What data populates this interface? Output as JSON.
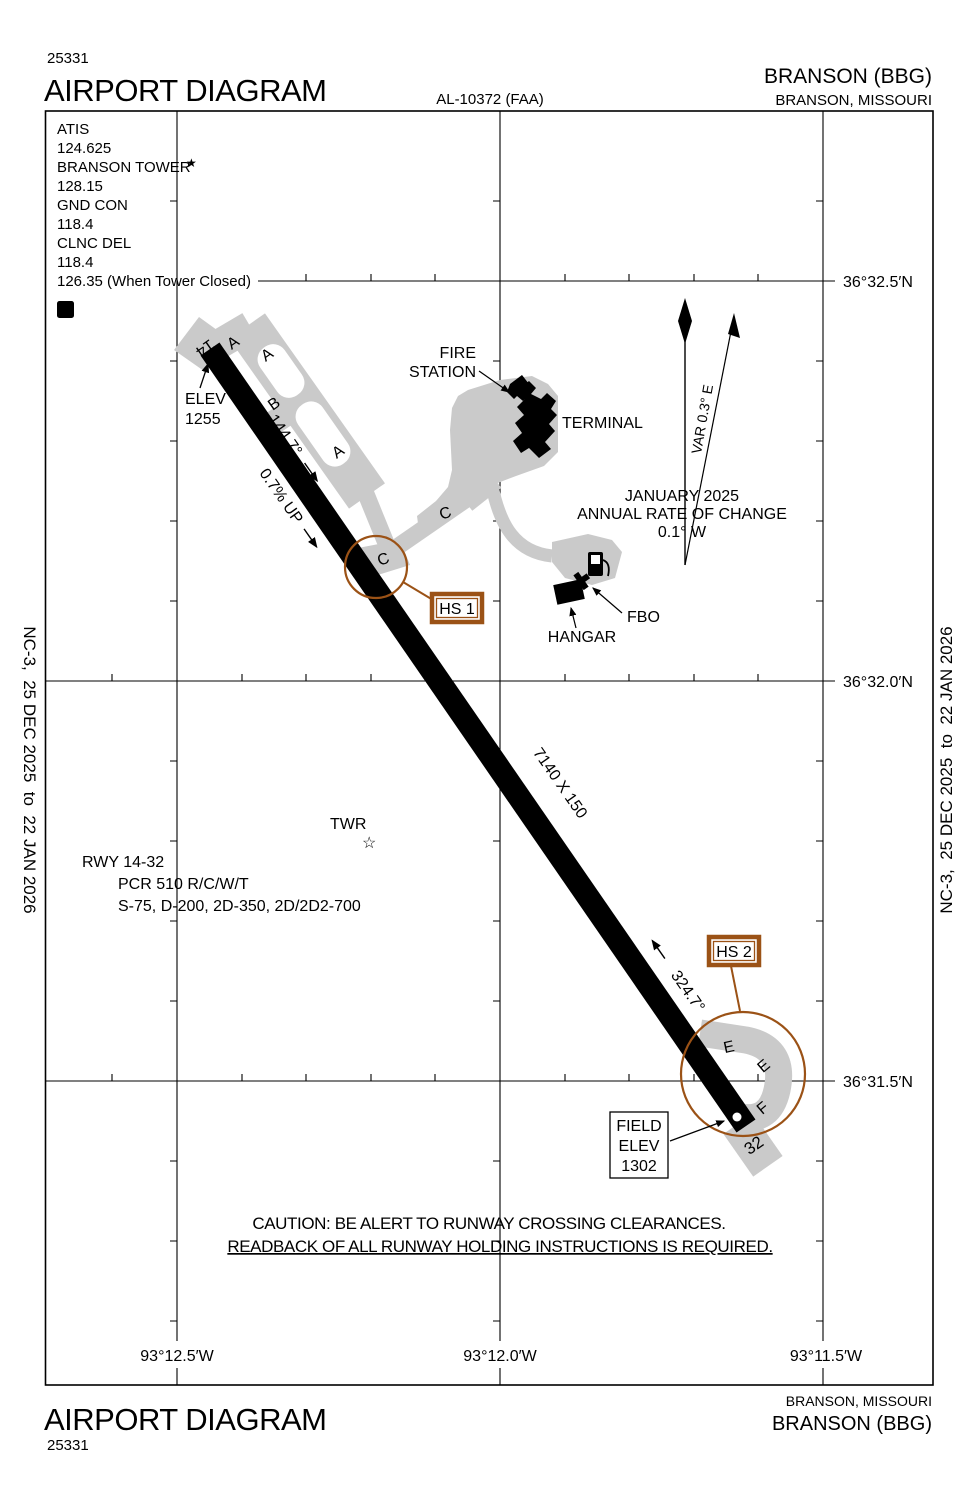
{
  "header": {
    "plate_code": "25331",
    "title": "AIRPORT DIAGRAM",
    "al_number": "AL-10372 (FAA)",
    "airport": "BRANSON (BBG)",
    "city": "BRANSON, MISSOURI"
  },
  "footer": {
    "plate_code": "25331",
    "title": "AIRPORT DIAGRAM",
    "airport": "BRANSON (BBG)",
    "city": "BRANSON, MISSOURI"
  },
  "margin_note": "NC-3,  25 DEC 2025  to  22 JAN 2026",
  "comm": {
    "lines": [
      "ATIS",
      "124.625",
      "BRANSON TOWER",
      "128.15",
      "GND CON",
      "118.4",
      "CLNC DEL",
      "118.4",
      "126.35 (When Tower Closed)"
    ],
    "tower_star": "★",
    "declared_distances_symbol": "D"
  },
  "compass": {
    "variation": "VAR 0.3° E",
    "epoch": "JANUARY 2025",
    "rate_label": "ANNUAL RATE OF CHANGE",
    "rate_value": "0.1° W"
  },
  "runway": {
    "id14": "14",
    "id32": "32",
    "heading14": "144.7°",
    "heading32": "324.7°",
    "slope": "0.7% UP",
    "dimensions": "7140 X 150",
    "threshold_elev_label": "ELEV",
    "threshold_elev_value": "1255"
  },
  "field_elev": {
    "l1": "FIELD",
    "l2": "ELEV",
    "l3": "1302"
  },
  "buildings": {
    "fire_station_l1": "FIRE",
    "fire_station_l2": "STATION",
    "terminal": "TERMINAL",
    "hangar": "HANGAR",
    "fbo": "FBO",
    "tower": "TWR",
    "tower_star": "☆"
  },
  "taxiways": {
    "a1": "A",
    "a2": "A",
    "b": "B",
    "a3": "A",
    "c1": "C",
    "c2": "C",
    "e1": "E",
    "e2": "E",
    "f": "F"
  },
  "hotspots": {
    "hs1": "HS 1",
    "hs2": "HS 2"
  },
  "runway_data": {
    "l1": "RWY 14-32",
    "l2": "PCR 510 R/C/W/T",
    "l3": "S-75, D-200, 2D-350, 2D/2D2-700"
  },
  "caution": {
    "l1": "CAUTION: BE ALERT TO RUNWAY CROSSING CLEARANCES.",
    "l2": "READBACK OF ALL RUNWAY HOLDING INSTRUCTIONS IS REQUIRED."
  },
  "graticule": {
    "lat": [
      "36°32.5′N",
      "36°32.0′N",
      "36°31.5′N"
    ],
    "lon": [
      "93°12.5′W",
      "93°12.0′W",
      "93°11.5′W"
    ]
  },
  "colors": {
    "pavement": "#CACACA",
    "hotspot_brown": "#9B5216"
  }
}
